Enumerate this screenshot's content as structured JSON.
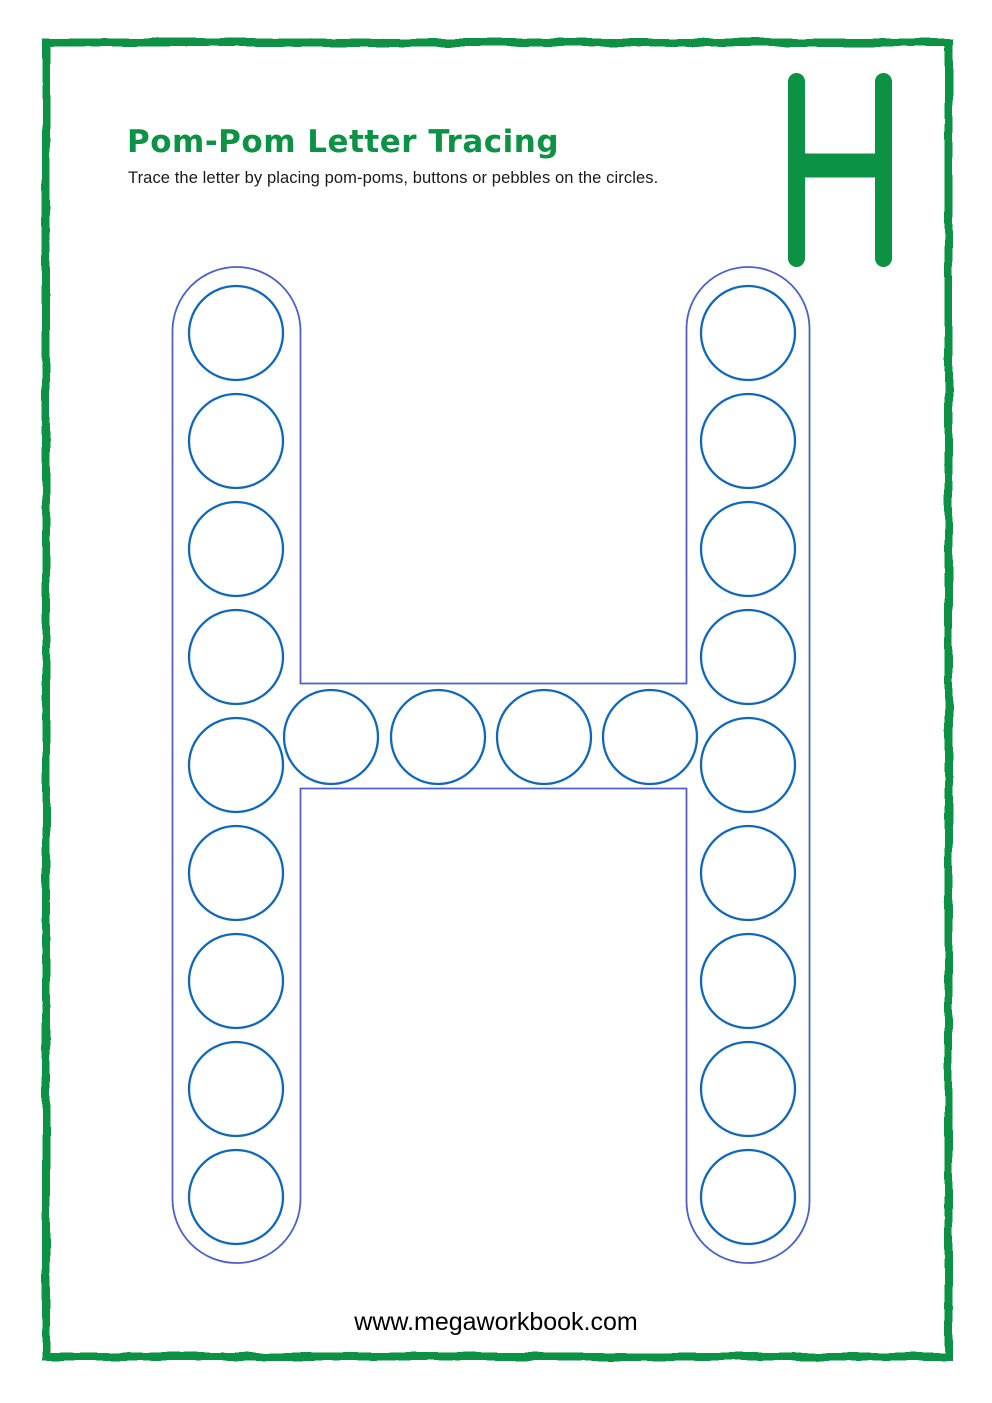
{
  "header": {
    "title": "Pom-Pom Letter Tracing",
    "subtitle": "Trace the letter by placing pom-poms, buttons or pebbles on the circles."
  },
  "corner_letter": {
    "value": "H"
  },
  "tracing": {
    "letter": "H",
    "circle_count": 22,
    "circle_radius": 47,
    "columns": {
      "left": {
        "cx": 236,
        "cy": [
          333,
          441,
          549,
          657,
          765,
          873,
          981,
          1089,
          1197
        ]
      },
      "right": {
        "cx": 748,
        "cy": [
          333,
          441,
          549,
          657,
          765,
          873,
          981,
          1089,
          1197
        ]
      }
    },
    "crossbar": {
      "cy": 737,
      "cx": [
        331,
        438,
        544,
        650
      ]
    },
    "outline": {
      "left_bar": {
        "x": 172.5,
        "y": 267,
        "width": 128,
        "height": 996,
        "radius": 64
      },
      "right_bar": {
        "x": 686.5,
        "y": 267,
        "width": 123,
        "height": 996,
        "radius": 61.5
      },
      "crossbar": {
        "x1": 299.5,
        "x2": 687,
        "y_top": 683.5,
        "y_bottom": 788.5
      }
    }
  },
  "footer": {
    "url": "www.megaworkbook.com"
  },
  "colors": {
    "green": "#0c9245",
    "outline_blue": "#4a62c6",
    "circle_blue": "#1268b8",
    "text": "#1a1a1a",
    "background": "#ffffff"
  }
}
